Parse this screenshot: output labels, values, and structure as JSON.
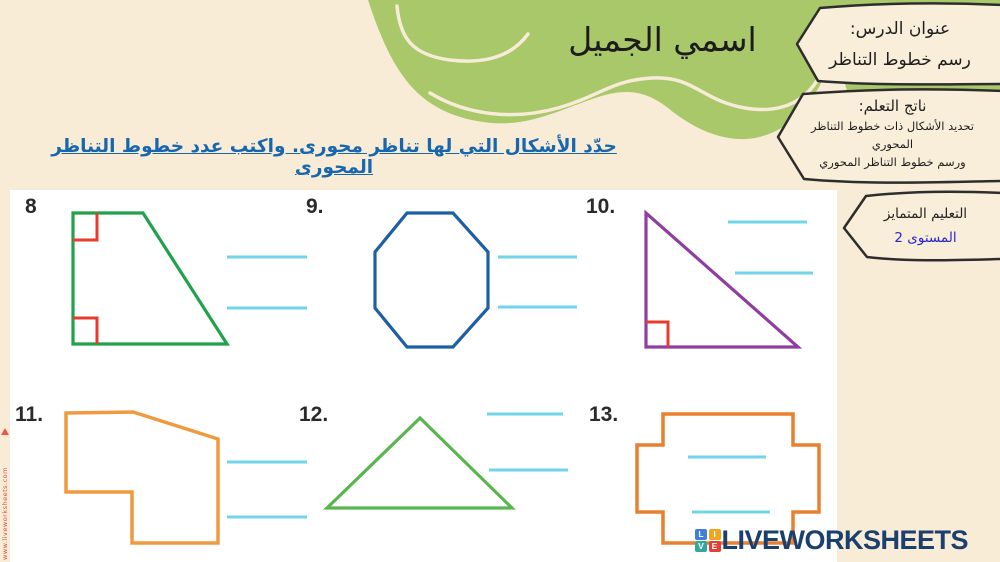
{
  "page": {
    "title": "اسمي الجميل",
    "background_color": "#f8ecd6",
    "blob_color": "#a9c869"
  },
  "banner_boxes": {
    "lesson_title": {
      "line1": "عنوان الدرس:",
      "line2": "رسم خطوط التناظر"
    },
    "learning_outcome": {
      "line1": "ناتج التعلم:",
      "line2": "تحديد الأشكال ذات خطوط التناظر المحوري",
      "line3": "ورسم خطوط التناظر المحوري"
    },
    "differentiated": {
      "line1": "التعليم المتمايز",
      "line2": "المستوى 2",
      "level_color": "#2626cc"
    }
  },
  "instruction": {
    "text": "حدّد الأشكال التي لها تناظر محورى. واكتب عدد خطوط التناظر المحورى",
    "color": "#1766ae"
  },
  "worksheet": {
    "answer_line_color": "#72d4e8",
    "right_angle_color": "#e83a2d",
    "items": [
      {
        "number": "8",
        "shape": "right-trapezoid",
        "color": "#1fa24a",
        "right_angle_marks": 2,
        "answer_lines": 2
      },
      {
        "number": "9.",
        "shape": "octagon",
        "color": "#1d5fa6",
        "right_angle_marks": 0,
        "answer_lines": 2
      },
      {
        "number": "10.",
        "shape": "right-triangle",
        "color": "#8f3da0",
        "right_angle_marks": 1,
        "answer_lines": 2
      },
      {
        "number": "11.",
        "shape": "irregular-polygon",
        "color": "#f09a3e",
        "right_angle_marks": 0,
        "answer_lines": 2
      },
      {
        "number": "12.",
        "shape": "triangle",
        "color": "#59b64f",
        "right_angle_marks": 0,
        "answer_lines": 2
      },
      {
        "number": "13.",
        "shape": "cross",
        "color": "#e8802f",
        "right_angle_marks": 0,
        "answer_lines": 2
      }
    ]
  },
  "watermark": {
    "text": "www.liveworksheets.com",
    "color": "#d9503f"
  },
  "logo": {
    "text": "LIVEWORKSHEETS",
    "color": "#1b3f6e",
    "blocks": [
      {
        "letter": "L",
        "color": "#3f7fd6"
      },
      {
        "letter": "I",
        "color": "#f2a51c"
      },
      {
        "letter": "V",
        "color": "#33a79d"
      },
      {
        "letter": "E",
        "color": "#e23f36"
      }
    ]
  }
}
